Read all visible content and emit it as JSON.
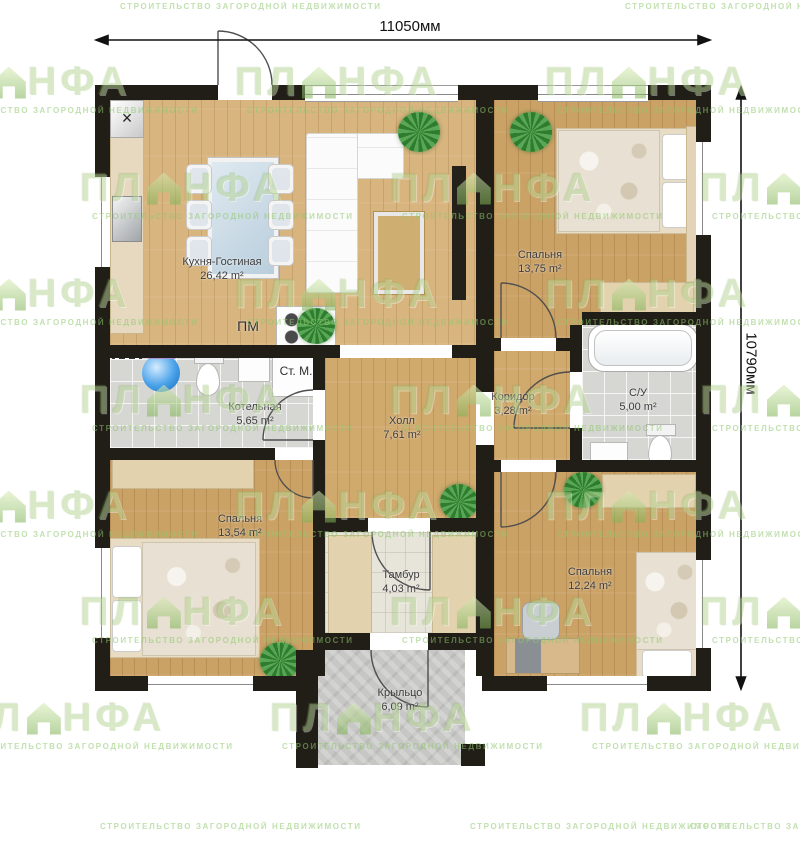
{
  "dimensions": {
    "width_label": "11050мм",
    "height_label": "10790мм"
  },
  "watermark": {
    "brand": "ПЛИНФА",
    "brand_left": "ПЛ",
    "brand_right": "НФА",
    "tagline": "СТРОИТЕЛЬСТВО ЗАГОРОДНОЙ НЕДВИЖИМОСТИ"
  },
  "rooms": {
    "kitchen": {
      "name": "Кухня-Гостиная",
      "area": "26,42 m²"
    },
    "bedroom_tr": {
      "name": "Спальня",
      "area": "13,75 m²"
    },
    "corridor": {
      "name": "Коридор",
      "area": "3,28 m²"
    },
    "bathroom": {
      "name": "С/У",
      "area": "5,00 m²"
    },
    "boiler": {
      "name": "Котельная",
      "area": "5,65 m²"
    },
    "hall": {
      "name": "Холл",
      "area": "7,61 m²"
    },
    "bedroom_bl": {
      "name": "Спальня",
      "area": "13,54 m²"
    },
    "tambour": {
      "name": "Тамбур",
      "area": "4,03 m²"
    },
    "bedroom_br": {
      "name": "Спальня",
      "area": "12,24 m²"
    },
    "porch": {
      "name": "Крыльцо",
      "area": "6,09 m²"
    }
  },
  "annotations": {
    "stove": "ПМ",
    "washing_machine": "Ст. М.",
    "vent": "×"
  },
  "colors": {
    "wall": "#211d17",
    "wood": "#cba266",
    "tile": "#d6d6d3",
    "watermark_green": "#8fc86e"
  }
}
